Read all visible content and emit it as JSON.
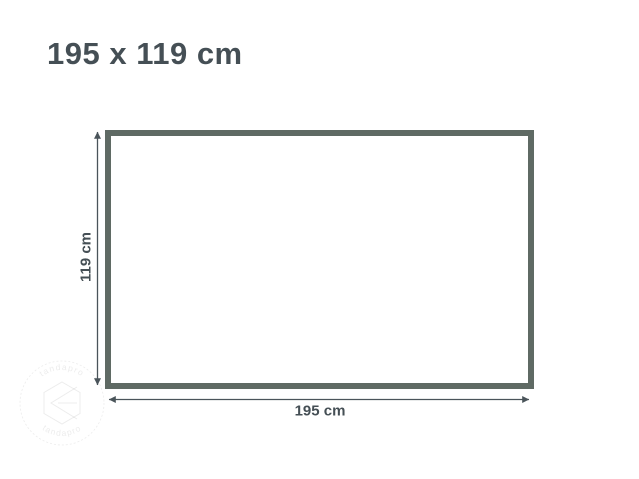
{
  "page": {
    "title": "195 x 119 cm",
    "background": "#ffffff"
  },
  "diagram": {
    "shape": "rectangle",
    "width_cm": 195,
    "height_cm": 119,
    "width_label": "195 cm",
    "height_label": "119 cm",
    "colors": {
      "outline": "#5f6a64",
      "label_text": "#454f55",
      "arrow": "#4a545a",
      "watermark": "rgba(70,70,70,0.10)"
    }
  },
  "watermark": {
    "badge": "hexagon-k-logo",
    "text_top": "tandapro",
    "text_bottom": "tandapro"
  }
}
